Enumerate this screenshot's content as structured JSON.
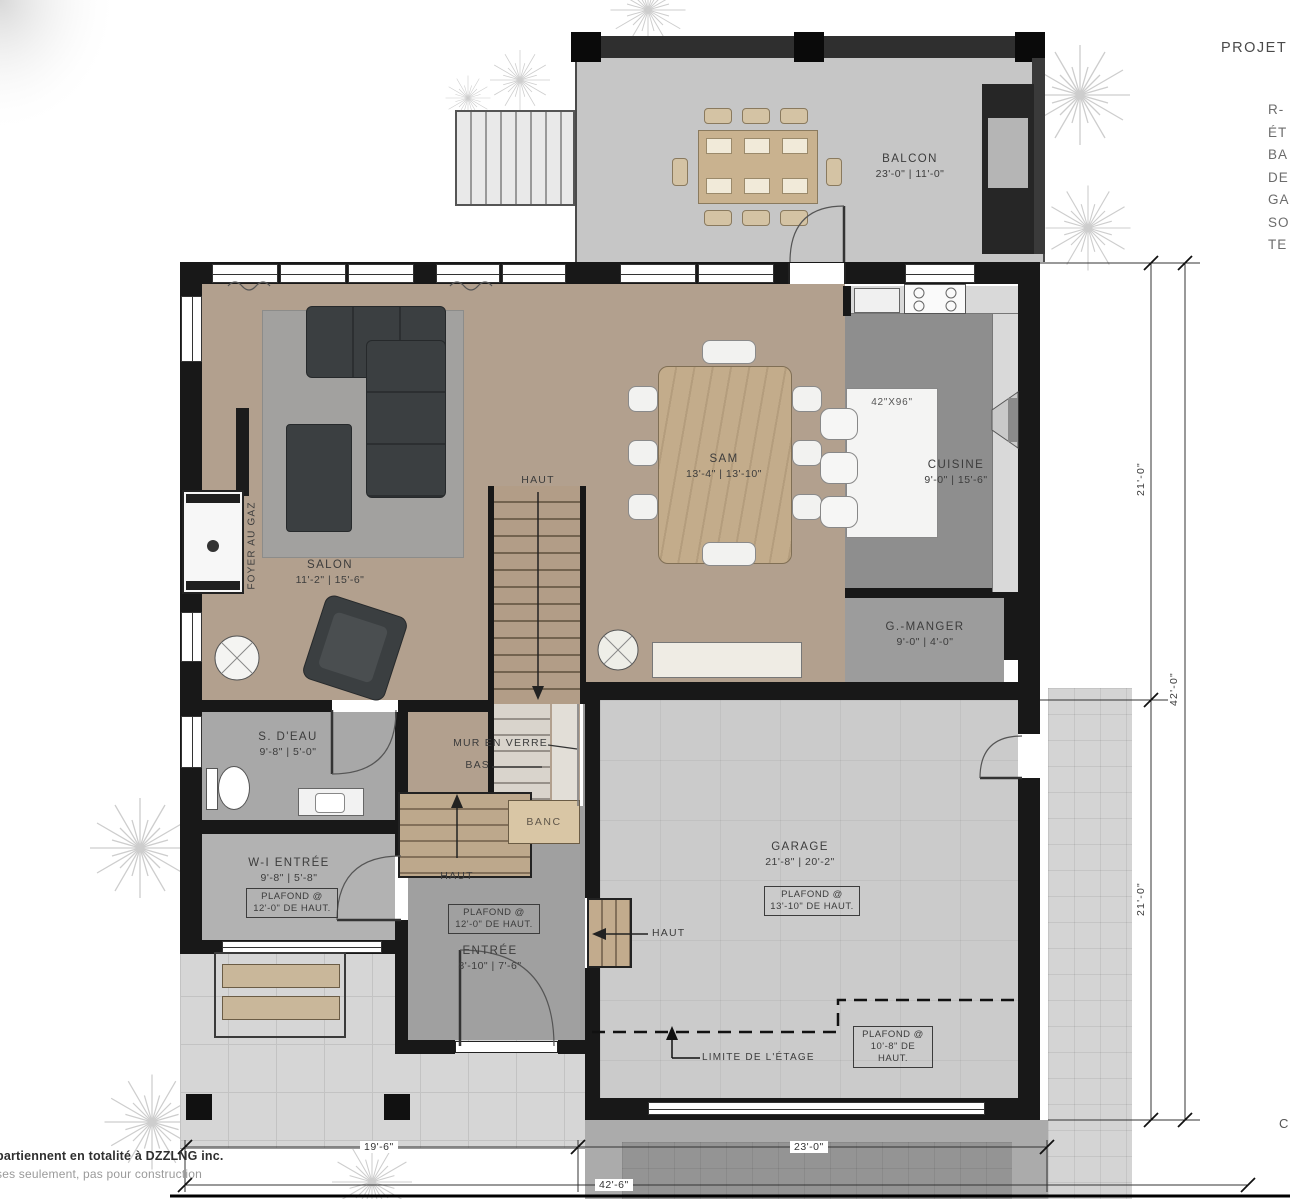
{
  "header": {
    "project": "PROJET 2",
    "legend": [
      "R-",
      "ÉT",
      "BA",
      "DE",
      "GA",
      "SO",
      "TE"
    ]
  },
  "rooms": {
    "balcon": {
      "name": "BALCON",
      "dims": "23'-0\" | 11'-0\""
    },
    "sam": {
      "name": "SAM",
      "dims": "13'-4\" | 13'-10\""
    },
    "cuisine": {
      "name": "CUISINE",
      "dims": "9'-0\" | 15'-6\""
    },
    "salon": {
      "name": "SALON",
      "dims": "11'-2\" | 15'-6\""
    },
    "gmanger": {
      "name": "G.-MANGER",
      "dims": "9'-0\" | 4'-0\""
    },
    "sdeau": {
      "name": "S. D'EAU",
      "dims": "9'-8\" | 5'-0\""
    },
    "wi_entree": {
      "name": "W-I ENTRÉE",
      "dims": "9'-8\" | 5'-8\""
    },
    "entree": {
      "name": "ENTRÉE",
      "dims": "8'-10\" | 7'-6\""
    },
    "garage": {
      "name": "GARAGE",
      "dims": "21'-8\" | 20'-2\""
    }
  },
  "annotations": {
    "island": "42\"X96\"",
    "foyer": "FOYER AU GAZ",
    "haut_top": "HAUT",
    "haut_lower": "HAUT",
    "haut_steps": "HAUT",
    "bas": "BAS",
    "mur_en_verre": "MUR EN VERRE",
    "banc": "BANC",
    "limite": "LIMITE DE L'ÉTAGE"
  },
  "plafond": {
    "wi": {
      "l1": "PLAFOND @",
      "l2": "12'-0\" DE HAUT."
    },
    "entree": {
      "l1": "PLAFOND @",
      "l2": "12'-0\" DE HAUT."
    },
    "garage": {
      "l1": "PLAFOND @",
      "l2": "13'-10\" DE HAUT."
    },
    "garage_low": {
      "l1": "PLAFOND @",
      "l2": "10'-8\" DE",
      "l3": "HAUT."
    }
  },
  "dimensions": {
    "right": [
      "21'-0\"",
      "42'-0\"",
      "21'-0\""
    ],
    "bottom": [
      "19'-6\"",
      "23'-0\"",
      "42'-6\""
    ]
  },
  "footer": {
    "line1": "partiennent en totalité à DZZLNG inc.",
    "line2": "ses seulement, pas pour construction",
    "corner": "C"
  },
  "colors": {
    "wood_floor": "#b2a08e",
    "gray_room": "#9c9c9c",
    "garage_floor": "#cbcbcb",
    "wall": "#181818",
    "wood_furniture": "#c9b28f",
    "sofa": "#3b3f41",
    "balcony": "#c6c6c6",
    "porch": "#d6d6d6"
  }
}
